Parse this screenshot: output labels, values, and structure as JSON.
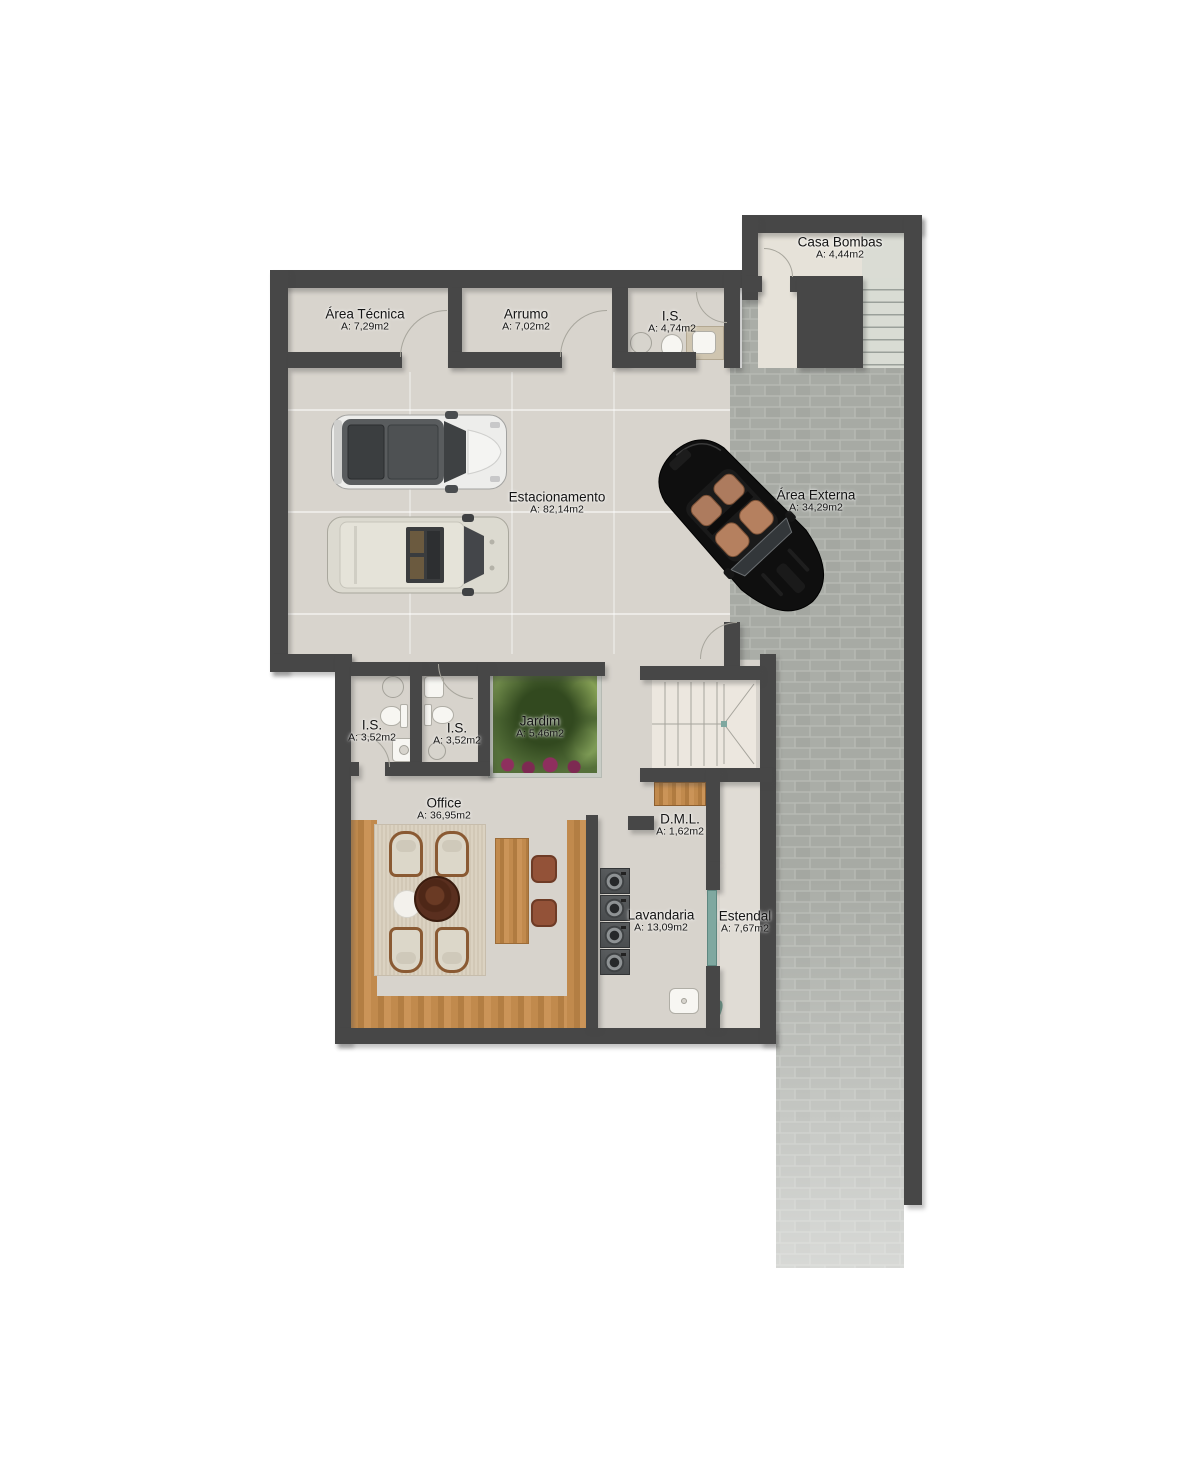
{
  "rooms": [
    {
      "id": "casa-bombas",
      "name": "Casa Bombas",
      "area": "A: 4,44m2"
    },
    {
      "id": "area-tecnica",
      "name": "Área Técnica",
      "area": "A: 7,29m2"
    },
    {
      "id": "arrumo",
      "name": "Arrumo",
      "area": "A: 7,02m2"
    },
    {
      "id": "is-garagem",
      "name": "I.S.",
      "area": "A: 4,74m2"
    },
    {
      "id": "estacionamento",
      "name": "Estacionamento",
      "area": "A: 82,14m2"
    },
    {
      "id": "area-externa",
      "name": "Área Externa",
      "area": "A: 34,29m2"
    },
    {
      "id": "is-esquerda",
      "name": "I.S.",
      "area": "A: 3,52m2"
    },
    {
      "id": "is-direita",
      "name": "I.S.",
      "area": "A: 3,52m2"
    },
    {
      "id": "jardim",
      "name": "Jardim",
      "area": "A: 5,46m2"
    },
    {
      "id": "office",
      "name": "Office",
      "area": "A: 36,95m2"
    },
    {
      "id": "dml",
      "name": "D.M.L.",
      "area": "A: 1,62m2"
    },
    {
      "id": "lavandaria",
      "name": "Lavandaria",
      "area": "A: 13,09m2"
    },
    {
      "id": "estendal",
      "name": "Estendal",
      "area": "A: 7,67m2"
    }
  ],
  "palette": {
    "wall": "#474747",
    "floor_interior": "#d8d4cd",
    "floor_light": "#ece7df",
    "brick_paving": "#a9aca6",
    "wood": "#c08a4e",
    "garden_green": "#55703a",
    "glass_door": "#7fa8a0",
    "car_black": "#111111",
    "car_white": "#ededeb",
    "car_beige": "#dddbd1"
  },
  "icons": [
    "white-suv-car",
    "beige-suv-car",
    "black-convertible-car",
    "washing-machine",
    "toilet",
    "sink",
    "shower-head",
    "staircase",
    "door-swing-arc",
    "dining-armchair",
    "coffee-table",
    "desk",
    "stool",
    "garden-planter",
    "glass-door",
    "laundry-sink",
    "vanity"
  ]
}
